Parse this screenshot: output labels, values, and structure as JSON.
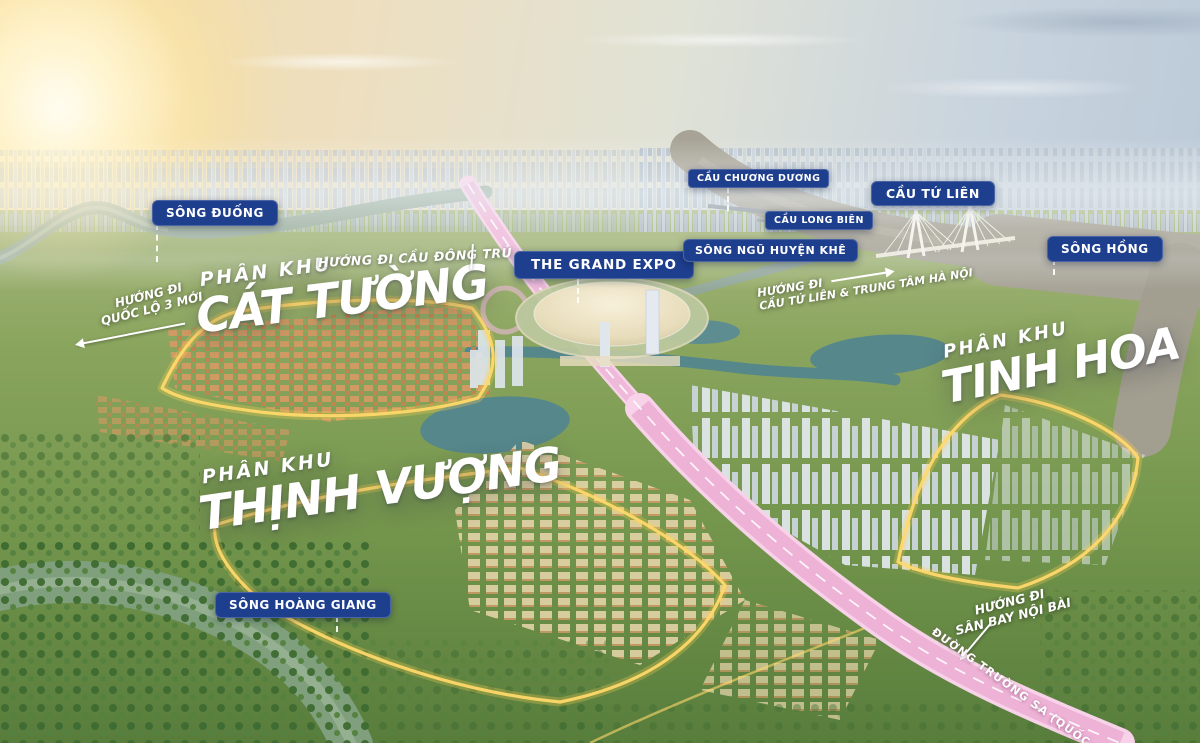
{
  "badges": {
    "song_duong": "SÔNG ĐUỐNG",
    "grand_expo": "THE GRAND EXPO",
    "cau_chuong_duong": "CẦU CHƯƠNG DƯƠNG",
    "cau_long_bien": "CẦU LONG BIÊN",
    "cau_tu_lien": "CẦU TỨ LIÊN",
    "song_ngu_huyen_khe": "SÔNG NGŨ HUYỆN KHÊ",
    "song_hong": "SÔNG HỒNG",
    "song_hoang_giang": "SÔNG HOÀNG GIANG"
  },
  "zones": {
    "cat_tuong": {
      "prefix": "PHÂN KHU",
      "name": "CÁT TƯỜNG"
    },
    "tinh_hoa": {
      "prefix": "PHÂN KHU",
      "name": "TINH HOA"
    },
    "thinh_vuong": {
      "prefix": "PHÂN KHU",
      "name": "THỊNH VƯỢNG"
    }
  },
  "directions": {
    "cau_dong_tru": {
      "text": "HƯỚNG ĐI CẦU ĐÔNG TRÙ"
    },
    "quoc_lo_3_moi": {
      "line1": "HƯỚNG ĐI",
      "line2": "QUỐC LỘ 3 MỚI"
    },
    "trung_tam_ha_noi": {
      "line1": "HƯỚNG ĐI",
      "line2": "CẦU TỨ LIÊN & TRUNG TÂM HÀ NỘI"
    },
    "san_bay_noi_bai": {
      "line1": "HƯỚNG ĐI",
      "line2": "SÂN BAY NỘI BÀI"
    }
  },
  "roads": {
    "truong_sa": "ĐƯỜNG TRƯỜNG SA (QUỐC LỘ 5)"
  },
  "colors": {
    "badge_bg": "#1e3f8e",
    "badge_text": "#ffffff",
    "road_pink": "#eeb2d6",
    "boundary_yellow": "#ffd24f",
    "headline_text": "#ffffff"
  }
}
